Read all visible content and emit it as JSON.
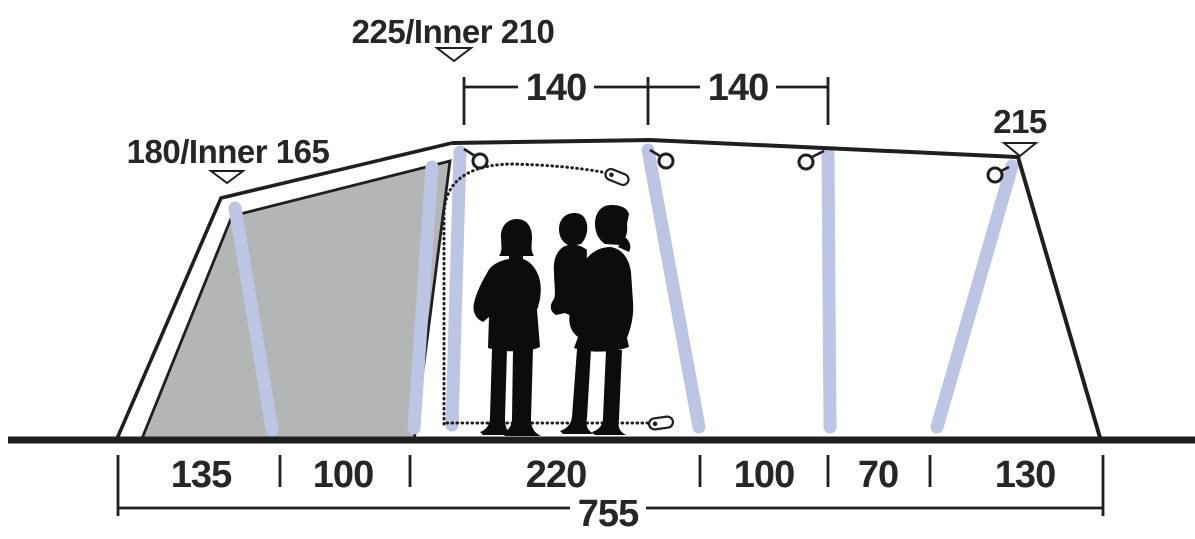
{
  "labels": {
    "peak_front": "180/Inner 165",
    "peak_main": "225/Inner 210",
    "peak_rear": "215"
  },
  "top_dims": {
    "segments": [
      "140",
      "140"
    ]
  },
  "bottom_dims": {
    "segments": [
      "135",
      "100",
      "220",
      "100",
      "70",
      "130"
    ],
    "total": "755"
  },
  "colors": {
    "line": "#1f1f1f",
    "text": "#262626",
    "panel": "#b4b6b5",
    "pole": "#bcc6e4",
    "background": "#ffffff"
  }
}
